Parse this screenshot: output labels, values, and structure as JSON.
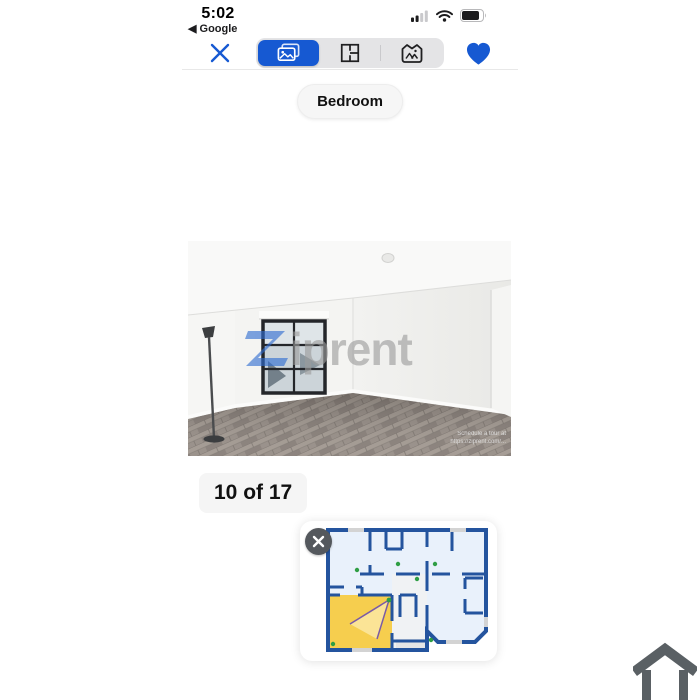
{
  "status_bar": {
    "time": "5:02",
    "back_to_app": "◀ Google"
  },
  "toolbar": {
    "segments": [
      {
        "name": "photos",
        "selected": true
      },
      {
        "name": "floor-plan",
        "selected": false
      },
      {
        "name": "map",
        "selected": false
      }
    ]
  },
  "viewer": {
    "room_label": "Bedroom",
    "counter": "10 of 17",
    "watermark_text": "iprent",
    "caption_line1": "Schedule a tour at",
    "caption_line2": "https://ziprent.com/..."
  },
  "icons": {
    "close": "x-icon",
    "favorite": "heart-icon",
    "segment_photos": "photos-icon",
    "segment_floor_plan": "floorplan-icon",
    "segment_map": "map-icon",
    "plan_close": "x-icon",
    "home_logo": "house-icon",
    "signal": "cellular-bars-icon",
    "wifi": "wifi-icon",
    "battery": "battery-icon"
  },
  "colors": {
    "accent_blue": "#1659D2",
    "plan_wall_blue": "#24549E",
    "plan_room_fill": "#E9F1FB",
    "highlight_yellow": "#F6CE4E",
    "photo_dot_green": "#2F9E44",
    "cone_purple": "#7A5BA6",
    "house_icon_gray": "#5A6064"
  }
}
